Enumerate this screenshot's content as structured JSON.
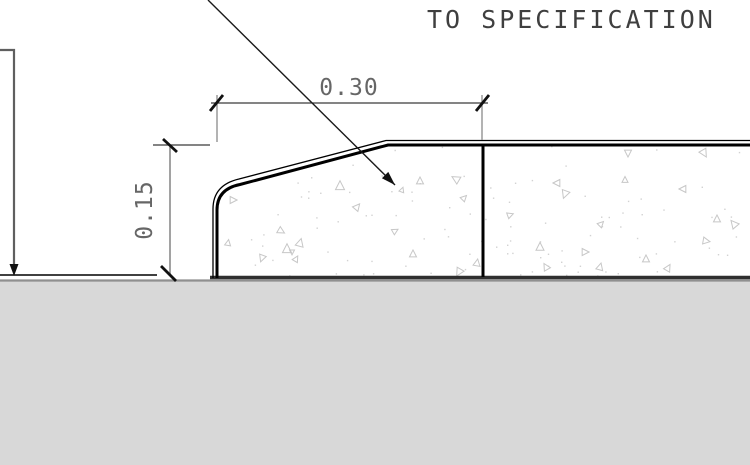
{
  "drawing": {
    "title_note": {
      "line": "TO SPECIFICATION"
    },
    "dimensions": {
      "width": {
        "value": "0.30",
        "orientation": "horizontal"
      },
      "height": {
        "value": "0.15",
        "orientation": "vertical"
      }
    },
    "colors": {
      "background": "#ffffff",
      "geometry": "#000000",
      "concrete_bottom": "#2f2f2f",
      "ground_fill": "#d8d8d8",
      "ground_edge": "#8f8f8f",
      "dim_line": "#3a3a3a",
      "extension_line": "#8a8a8a",
      "tick": "#111111",
      "dim_text": "#666666",
      "note_text": "#3f3f3f",
      "leader": "#5f5f5f",
      "leader_diag": "#1a1a1a",
      "hatch_stroke": "#c7c7c7",
      "dot_fill": "#d2d2d2"
    },
    "hatch": {
      "dot_seed": 7,
      "dot_count": 110,
      "triangles": [
        {
          "x": 340,
          "y": 186,
          "s": 9,
          "r": 0
        },
        {
          "x": 402,
          "y": 190,
          "s": 5,
          "r": 20
        },
        {
          "x": 357,
          "y": 207,
          "s": 7,
          "r": 40
        },
        {
          "x": 300,
          "y": 243,
          "s": 8,
          "r": 15
        },
        {
          "x": 262,
          "y": 258,
          "s": 7,
          "r": 200
        },
        {
          "x": 233,
          "y": 200,
          "s": 7,
          "r": 90
        },
        {
          "x": 228,
          "y": 243,
          "s": 6,
          "r": 10
        },
        {
          "x": 281,
          "y": 231,
          "s": 7,
          "r": 120
        },
        {
          "x": 287,
          "y": 249,
          "s": 9,
          "r": 0
        },
        {
          "x": 292,
          "y": 252,
          "s": 5,
          "r": 180
        },
        {
          "x": 296,
          "y": 259,
          "s": 6,
          "r": 30
        },
        {
          "x": 420,
          "y": 181,
          "s": 7,
          "r": 0
        },
        {
          "x": 456,
          "y": 179,
          "s": 8,
          "r": 300
        },
        {
          "x": 464,
          "y": 198,
          "s": 6,
          "r": 45
        },
        {
          "x": 477,
          "y": 263,
          "s": 7,
          "r": 10
        },
        {
          "x": 459,
          "y": 272,
          "s": 8,
          "r": 210
        },
        {
          "x": 413,
          "y": 254,
          "s": 7,
          "r": 0
        },
        {
          "x": 395,
          "y": 231,
          "s": 6,
          "r": 60
        },
        {
          "x": 540,
          "y": 247,
          "s": 8,
          "r": 0
        },
        {
          "x": 546,
          "y": 267,
          "s": 7,
          "r": 330
        },
        {
          "x": 557,
          "y": 183,
          "s": 7,
          "r": 270
        },
        {
          "x": 565,
          "y": 194,
          "s": 8,
          "r": 200
        },
        {
          "x": 628,
          "y": 153,
          "s": 7,
          "r": 180
        },
        {
          "x": 704,
          "y": 153,
          "s": 8,
          "r": 150
        },
        {
          "x": 683,
          "y": 189,
          "s": 7,
          "r": 270
        },
        {
          "x": 717,
          "y": 219,
          "s": 7,
          "r": 0
        },
        {
          "x": 734,
          "y": 224,
          "s": 8,
          "r": 320
        },
        {
          "x": 706,
          "y": 241,
          "s": 7,
          "r": 100
        },
        {
          "x": 646,
          "y": 259,
          "s": 7,
          "r": 0
        },
        {
          "x": 601,
          "y": 224,
          "s": 6,
          "r": 45
        },
        {
          "x": 585,
          "y": 252,
          "s": 7,
          "r": 90
        },
        {
          "x": 625,
          "y": 180,
          "s": 6,
          "r": 0
        },
        {
          "x": 668,
          "y": 268,
          "s": 7,
          "r": 30
        },
        {
          "x": 600,
          "y": 267,
          "s": 7,
          "r": 15
        },
        {
          "x": 510,
          "y": 215,
          "s": 6,
          "r": 70
        }
      ]
    }
  }
}
